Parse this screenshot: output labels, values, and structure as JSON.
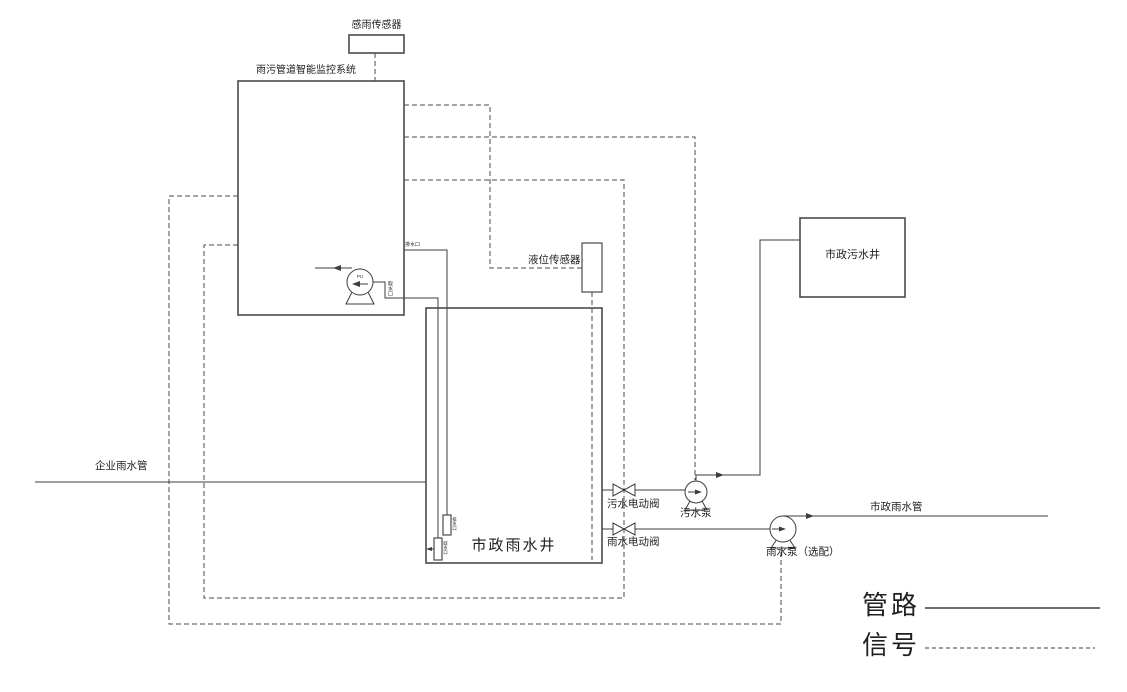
{
  "colors": {
    "line": "#3d3d3d",
    "box_line": "#4a4a4a",
    "text": "#1f1f1f",
    "background": "#ffffff"
  },
  "sensors": {
    "rain_sensor": {
      "label": "感雨传感器"
    },
    "level_sensor": {
      "label": "液位传感器"
    }
  },
  "system": {
    "monitoring": {
      "label": "雨污管道智能监控系统"
    },
    "monitor_pump": {
      "tag": "PU"
    },
    "ports": {
      "drain_outlet": "排水口",
      "water_intake": "取水口"
    }
  },
  "wells": {
    "sewage_well": {
      "label": "市政污水井"
    },
    "rainwater_well": {
      "label": "市政雨水井"
    },
    "ports": {
      "drain_end": "排水口",
      "intake_end": "取水口"
    }
  },
  "pipes": {
    "enterprise_rain_pipe": {
      "label": "企业雨水管"
    },
    "municipal_rain_pipe": {
      "label": "市政雨水管"
    }
  },
  "equipment": {
    "sewage_valve": {
      "label": "污水电动阀"
    },
    "sewage_pump": {
      "label": "污水泵"
    },
    "rain_valve": {
      "label": "雨水电动阀"
    },
    "rain_pump": {
      "label": "雨水泵（选配）"
    }
  },
  "legend": {
    "pipeline": "管路",
    "signal": "信号"
  }
}
